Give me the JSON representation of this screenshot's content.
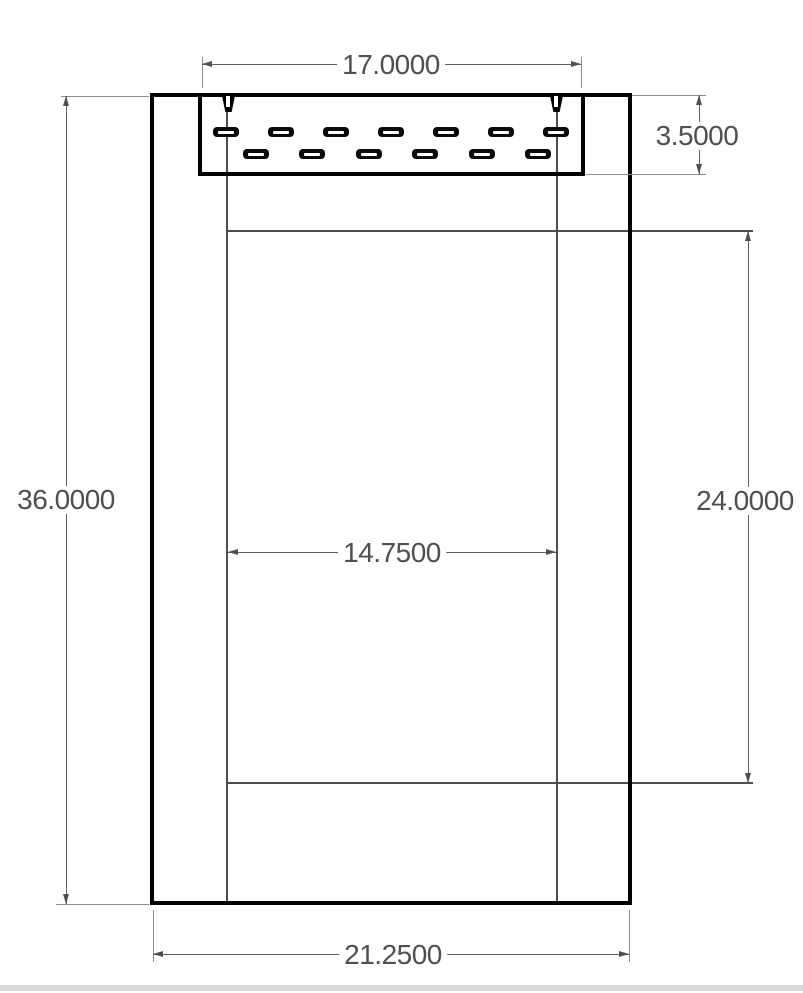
{
  "page": {
    "background": "#ffffff",
    "footer_bar_color": "#d9d9d9"
  },
  "drawing": {
    "type": "dimensioned-panel-drawing",
    "description": "CAD-style dimensioned front view of a panel/door with top vent grille",
    "dimensions": {
      "vent_width": "17.0000",
      "vent_height": "3.5000",
      "overall_height": "36.0000",
      "opening_height": "24.0000",
      "opening_width": "14.7500",
      "overall_width": "21.2500"
    },
    "vent_grille": {
      "slot_rows": 2,
      "top_row_slot_count": 7,
      "bottom_row_slot_count": 6,
      "clip_count": 2
    },
    "line_colors": {
      "object": "#000000",
      "secondary": "#4d4d4d",
      "dimension": "#5f5f5f",
      "extension": "#8c8c8c",
      "text": "#4f4f4f"
    }
  }
}
